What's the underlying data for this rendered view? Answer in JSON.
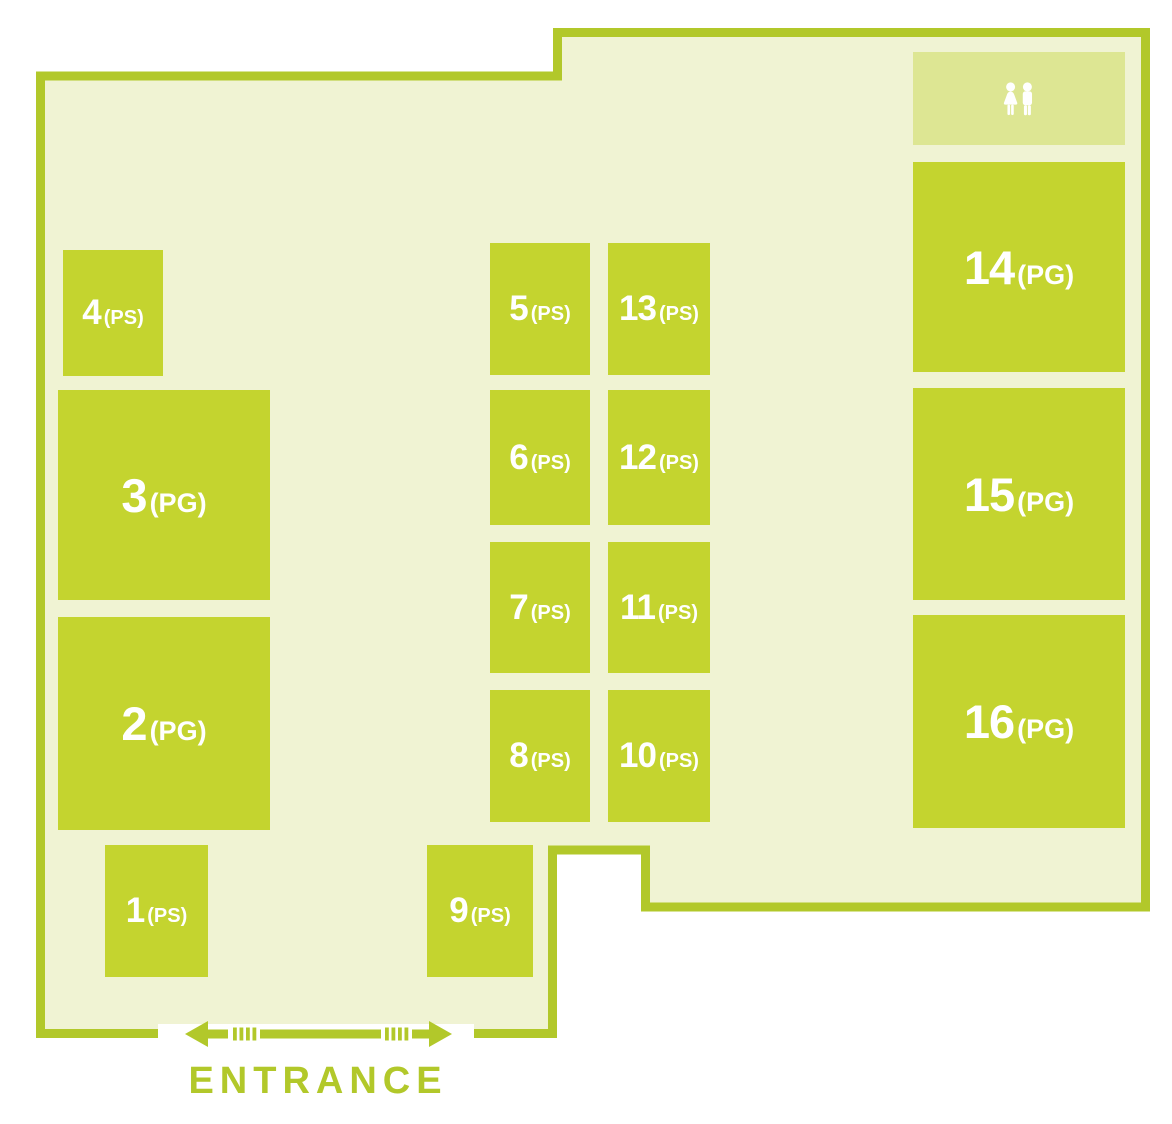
{
  "palette": {
    "page_bg": "#ffffff",
    "floor": "#f0f3d3",
    "booth": "#c4d42f",
    "border": "#b2c82a",
    "restroom": "#dde693",
    "label": "#ffffff"
  },
  "map": {
    "entrance_label": "ENTRANCE",
    "restroom": {
      "icon": "restroom-icon"
    },
    "booths": [
      {
        "number": "1",
        "suffix": "(PS)",
        "size": "small",
        "x": 105,
        "y": 845,
        "w": 103,
        "h": 132
      },
      {
        "number": "2",
        "suffix": "(PG)",
        "size": "large",
        "x": 58,
        "y": 617,
        "w": 212,
        "h": 213
      },
      {
        "number": "3",
        "suffix": "(PG)",
        "size": "large",
        "x": 58,
        "y": 390,
        "w": 212,
        "h": 210
      },
      {
        "number": "4",
        "suffix": "(PS)",
        "size": "small",
        "x": 63,
        "y": 250,
        "w": 100,
        "h": 126
      },
      {
        "number": "5",
        "suffix": "(PS)",
        "size": "small",
        "x": 490,
        "y": 243,
        "w": 100,
        "h": 132
      },
      {
        "number": "6",
        "suffix": "(PS)",
        "size": "small",
        "x": 490,
        "y": 390,
        "w": 100,
        "h": 135
      },
      {
        "number": "7",
        "suffix": "(PS)",
        "size": "small",
        "x": 490,
        "y": 542,
        "w": 100,
        "h": 131
      },
      {
        "number": "8",
        "suffix": "(PS)",
        "size": "small",
        "x": 490,
        "y": 690,
        "w": 100,
        "h": 132
      },
      {
        "number": "9",
        "suffix": "(PS)",
        "size": "small",
        "x": 427,
        "y": 845,
        "w": 106,
        "h": 132
      },
      {
        "number": "10",
        "suffix": "(PS)",
        "size": "small",
        "x": 608,
        "y": 690,
        "w": 102,
        "h": 132
      },
      {
        "number": "11",
        "suffix": "(PS)",
        "size": "small",
        "x": 608,
        "y": 542,
        "w": 102,
        "h": 131
      },
      {
        "number": "12",
        "suffix": "(PS)",
        "size": "small",
        "x": 608,
        "y": 390,
        "w": 102,
        "h": 135
      },
      {
        "number": "13",
        "suffix": "(PS)",
        "size": "small",
        "x": 608,
        "y": 243,
        "w": 102,
        "h": 132
      },
      {
        "number": "14",
        "suffix": "(PG)",
        "size": "large",
        "x": 913,
        "y": 162,
        "w": 212,
        "h": 210
      },
      {
        "number": "15",
        "suffix": "(PG)",
        "size": "large",
        "x": 913,
        "y": 388,
        "w": 212,
        "h": 212
      },
      {
        "number": "16",
        "suffix": "(PG)",
        "size": "large",
        "x": 913,
        "y": 615,
        "w": 212,
        "h": 213
      }
    ],
    "restroom_box": {
      "x": 913,
      "y": 52,
      "w": 212,
      "h": 93
    }
  }
}
